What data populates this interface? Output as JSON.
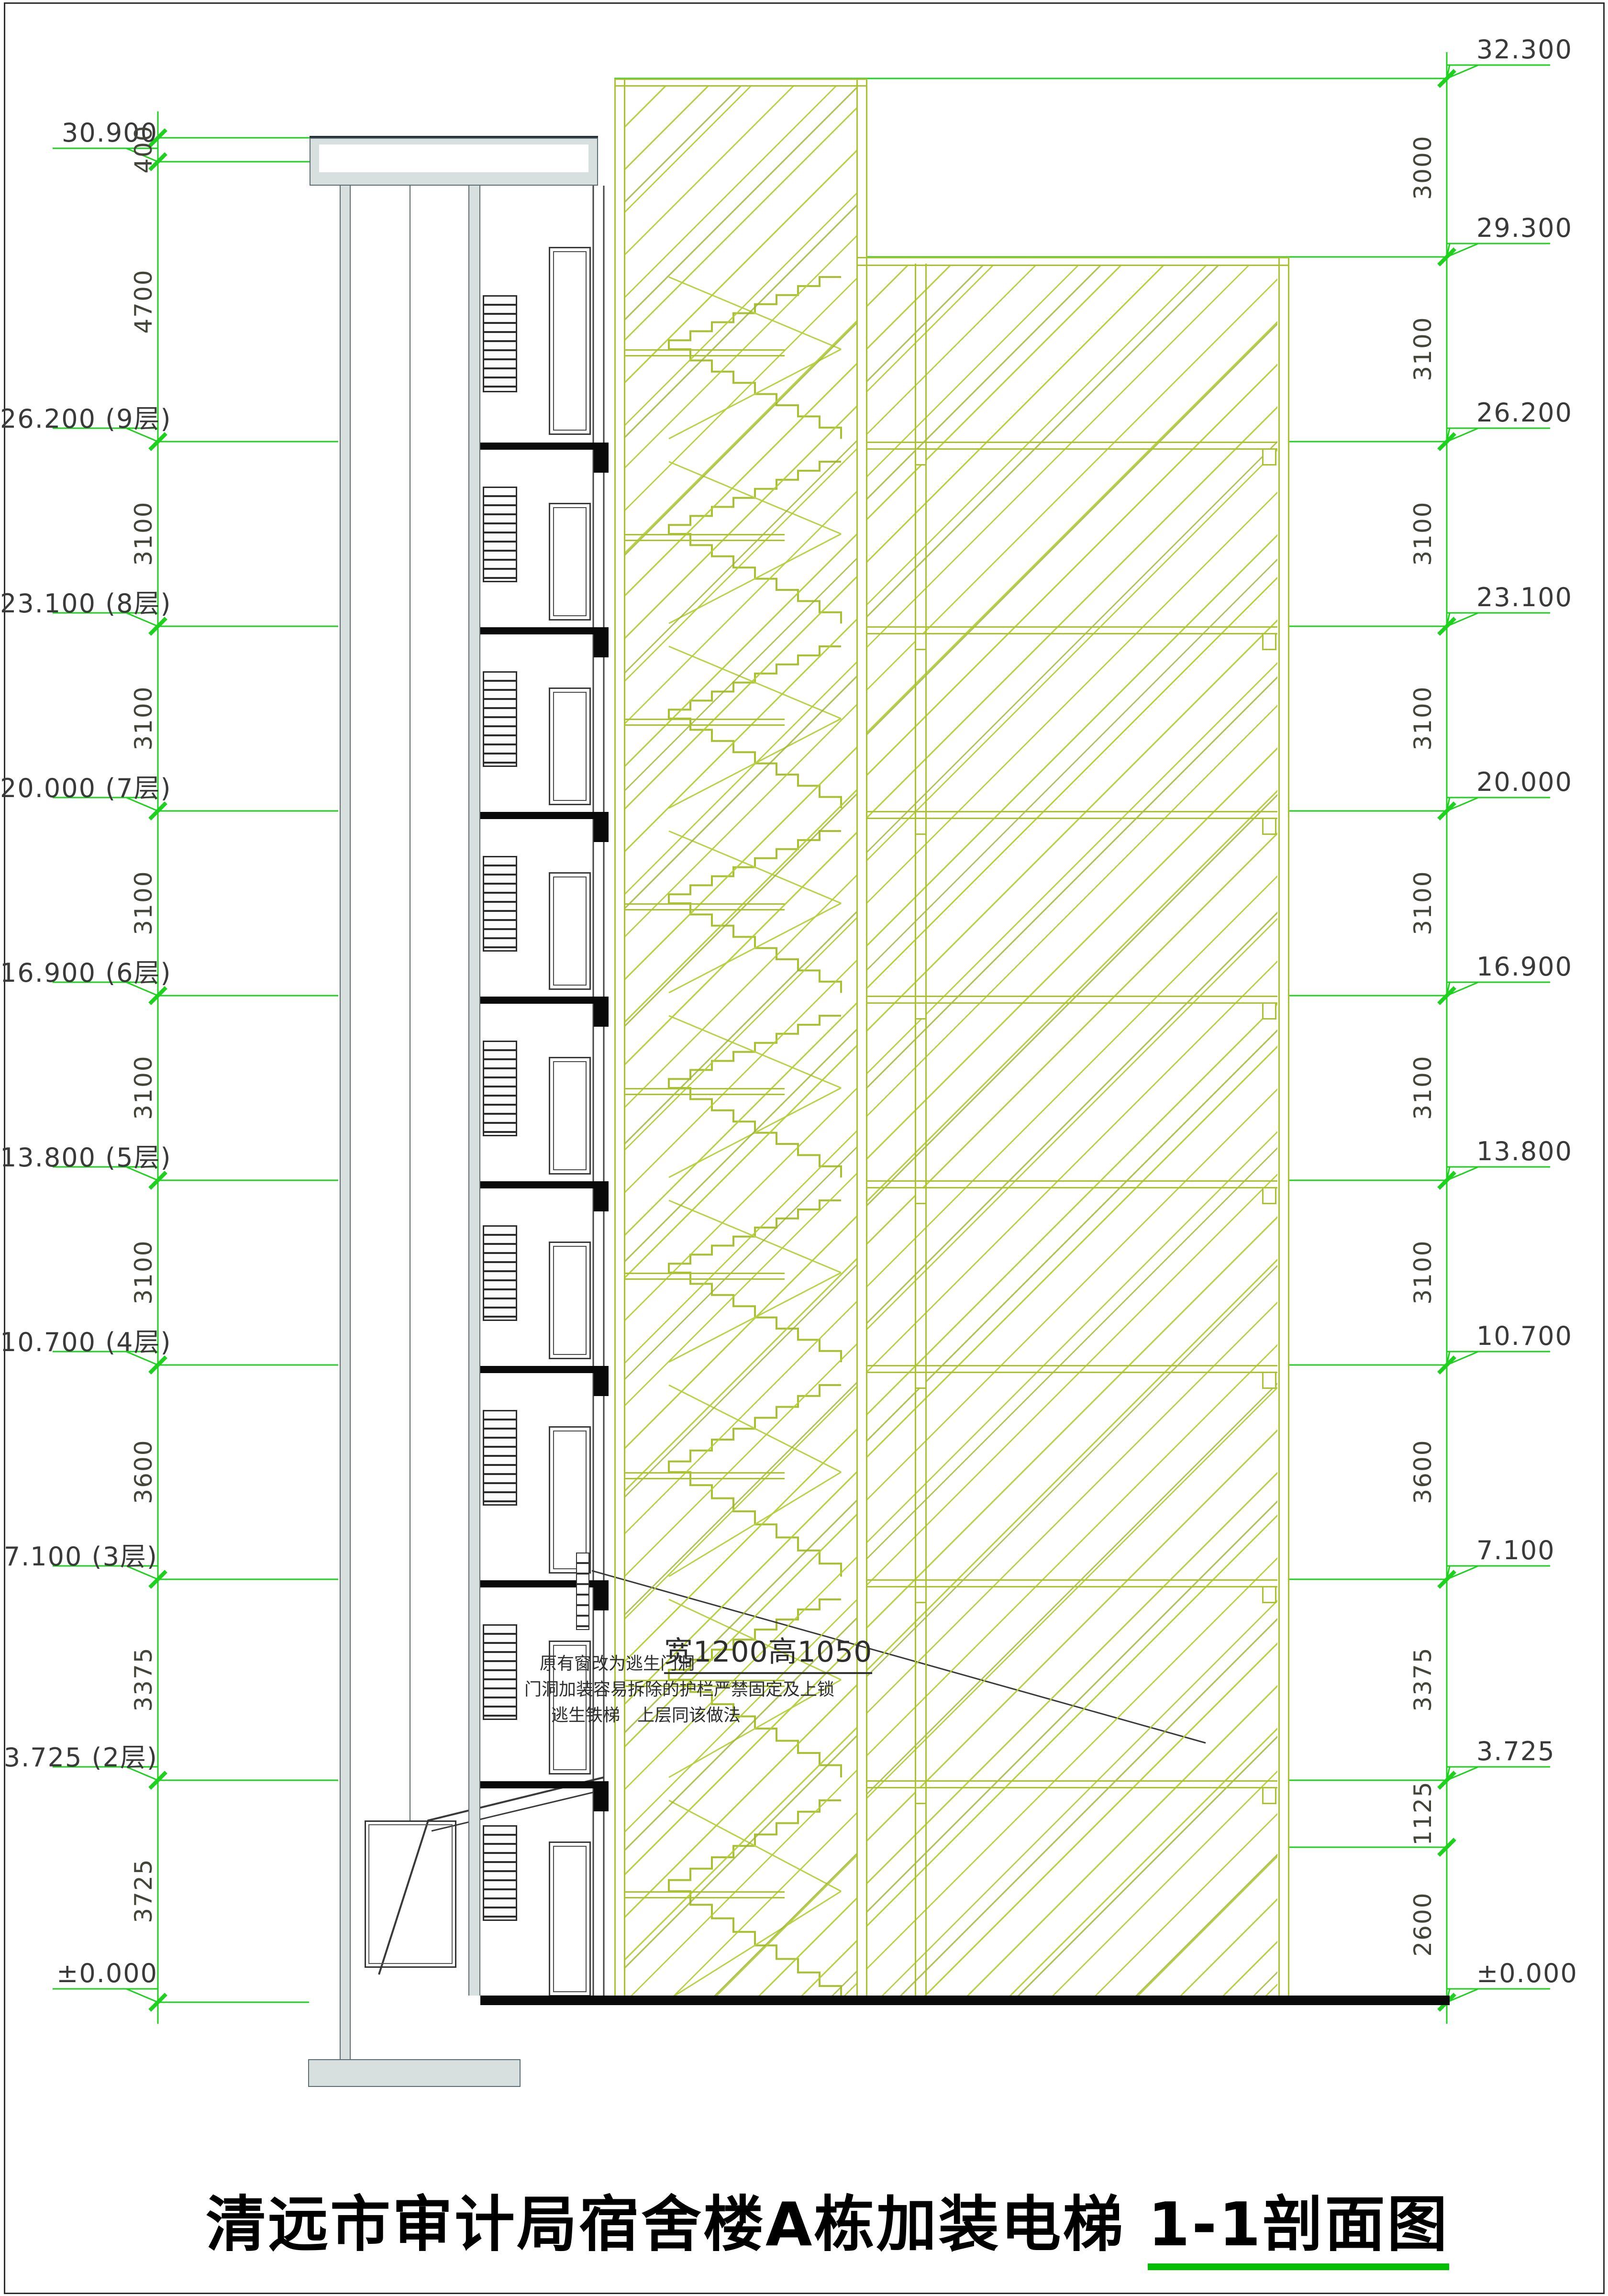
{
  "title": {
    "main": "清远市审计局宿舍楼A栋加装电梯 ",
    "underlined": "1-1剖面图"
  },
  "annotation": {
    "line1_small": "原有窗改为逃生门洞",
    "line1_large": "宽1200高1050",
    "line2": "门洞加装容易拆除的护栏严禁固定及上锁",
    "line3": "逃生铁梯　上层同该做法"
  },
  "left_column": {
    "markers": [
      {
        "label": "30.900",
        "floor": "",
        "mm": 30900
      },
      {
        "label": "26.200",
        "floor": "(9层)",
        "mm": 26200
      },
      {
        "label": "23.100",
        "floor": "(8层)",
        "mm": 23100
      },
      {
        "label": "20.000",
        "floor": "(7层)",
        "mm": 20000
      },
      {
        "label": "16.900",
        "floor": "(6层)",
        "mm": 16900
      },
      {
        "label": "13.800",
        "floor": "(5层)",
        "mm": 13800
      },
      {
        "label": "10.700",
        "floor": "(4层)",
        "mm": 10700
      },
      {
        "label": "7.100",
        "floor": "(3层)",
        "mm": 7100
      },
      {
        "label": "3.725",
        "floor": "(2层)",
        "mm": 3725
      },
      {
        "label": "±0.000",
        "floor": "",
        "mm": 0
      }
    ],
    "ticks_mm": [
      31300,
      30900,
      26200,
      23100,
      20000,
      16900,
      13800,
      10700,
      7100,
      3725,
      0
    ],
    "dims": [
      {
        "a": 31300,
        "b": 30900,
        "label": "400"
      },
      {
        "a": 30900,
        "b": 26200,
        "label": "4700"
      },
      {
        "a": 26200,
        "b": 23100,
        "label": "3100"
      },
      {
        "a": 23100,
        "b": 20000,
        "label": "3100"
      },
      {
        "a": 20000,
        "b": 16900,
        "label": "3100"
      },
      {
        "a": 16900,
        "b": 13800,
        "label": "3100"
      },
      {
        "a": 13800,
        "b": 10700,
        "label": "3100"
      },
      {
        "a": 10700,
        "b": 7100,
        "label": "3600"
      },
      {
        "a": 7100,
        "b": 3725,
        "label": "3375"
      },
      {
        "a": 3725,
        "b": 0,
        "label": "3725"
      }
    ]
  },
  "right_column": {
    "markers": [
      {
        "label": "32.300",
        "mm": 32300
      },
      {
        "label": "29.300",
        "mm": 29300
      },
      {
        "label": "26.200",
        "mm": 26200
      },
      {
        "label": "23.100",
        "mm": 23100
      },
      {
        "label": "20.000",
        "mm": 20000
      },
      {
        "label": "16.900",
        "mm": 16900
      },
      {
        "label": "13.800",
        "mm": 13800
      },
      {
        "label": "10.700",
        "mm": 10700
      },
      {
        "label": "7.100",
        "mm": 7100
      },
      {
        "label": "3.725",
        "mm": 3725
      },
      {
        "label": "±0.000",
        "mm": 0
      }
    ],
    "ticks_mm": [
      32300,
      29300,
      26200,
      23100,
      20000,
      16900,
      13800,
      10700,
      7100,
      3725,
      2600,
      0
    ],
    "dims": [
      {
        "a": 32300,
        "b": 29300,
        "label": "3000"
      },
      {
        "a": 29300,
        "b": 26200,
        "label": "3100"
      },
      {
        "a": 26200,
        "b": 23100,
        "label": "3100"
      },
      {
        "a": 23100,
        "b": 20000,
        "label": "3100"
      },
      {
        "a": 20000,
        "b": 16900,
        "label": "3100"
      },
      {
        "a": 16900,
        "b": 13800,
        "label": "3100"
      },
      {
        "a": 13800,
        "b": 10700,
        "label": "3100"
      },
      {
        "a": 10700,
        "b": 7100,
        "label": "3600"
      },
      {
        "a": 7100,
        "b": 3725,
        "label": "3375"
      },
      {
        "a": 3725,
        "b": 2600,
        "label": "1125"
      },
      {
        "a": 2600,
        "b": 0,
        "label": "2600"
      }
    ]
  },
  "building": {
    "floor_slab_levels_mm": [
      26200,
      23100,
      20000,
      16900,
      13800,
      10700,
      7100,
      3725
    ],
    "stair_levels_mm": [
      29300,
      26200,
      23100,
      20000,
      16900,
      13800,
      10700,
      7100,
      3725,
      0
    ]
  },
  "colors": {
    "marker_green": "#1fd11f",
    "hatch_green": "#b4cf3d",
    "wall_green": "#a9c42f",
    "shaft_gray": "#d8dfdf",
    "ink": "#3a3a3a",
    "slab_black": "#0a0a0a",
    "title_underline_green": "#00bf00"
  }
}
